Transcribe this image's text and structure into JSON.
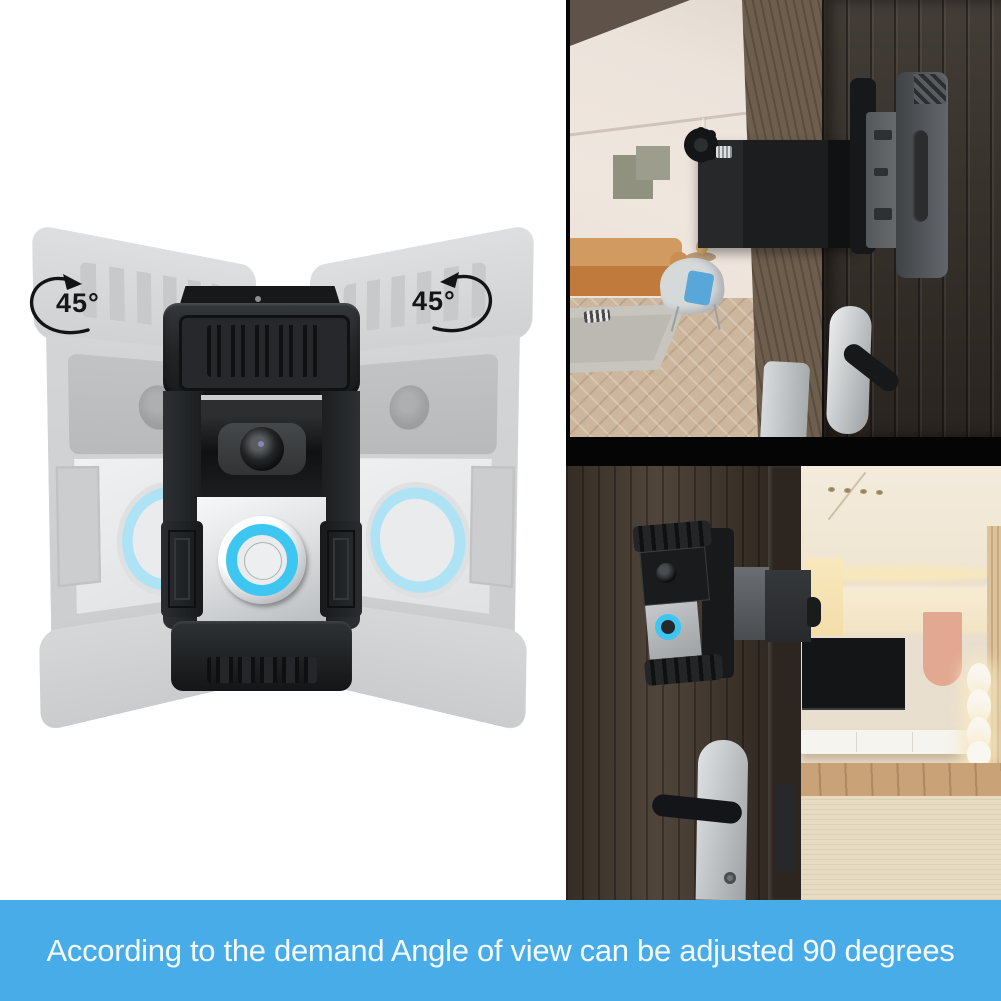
{
  "diagram": {
    "left_angle": "45°",
    "right_angle": "45°",
    "left_arrow_icon": "rotate-counterclockwise-arrow",
    "right_arrow_icon": "rotate-clockwise-arrow",
    "subject": "video-doorbell-in-anti-theft-bracket",
    "ghosts": "two faded copies of doorbell swung 45 degrees left and right"
  },
  "photos": {
    "top": "doorbell bracket clamped on door edge with thumbscrew, living room with orange sofa behind",
    "bottom": "video doorbell installed beside door handle, modern living room with TV wall"
  },
  "banner": {
    "text": "According to the demand Angle of view can be adjusted 90 degrees",
    "background": "#48ACE8",
    "text_color": "#F5F9FB"
  },
  "colors": {
    "button_ring_cyan": "#3CC6F1",
    "device_black": "#202224",
    "faceplate_silver": "#E9EBED",
    "ghost_gray": "#B4B6B8",
    "door_wood_dark": "#352E28",
    "door_wood_brown": "#463B30",
    "interior_cream": "#EAE0D0"
  }
}
